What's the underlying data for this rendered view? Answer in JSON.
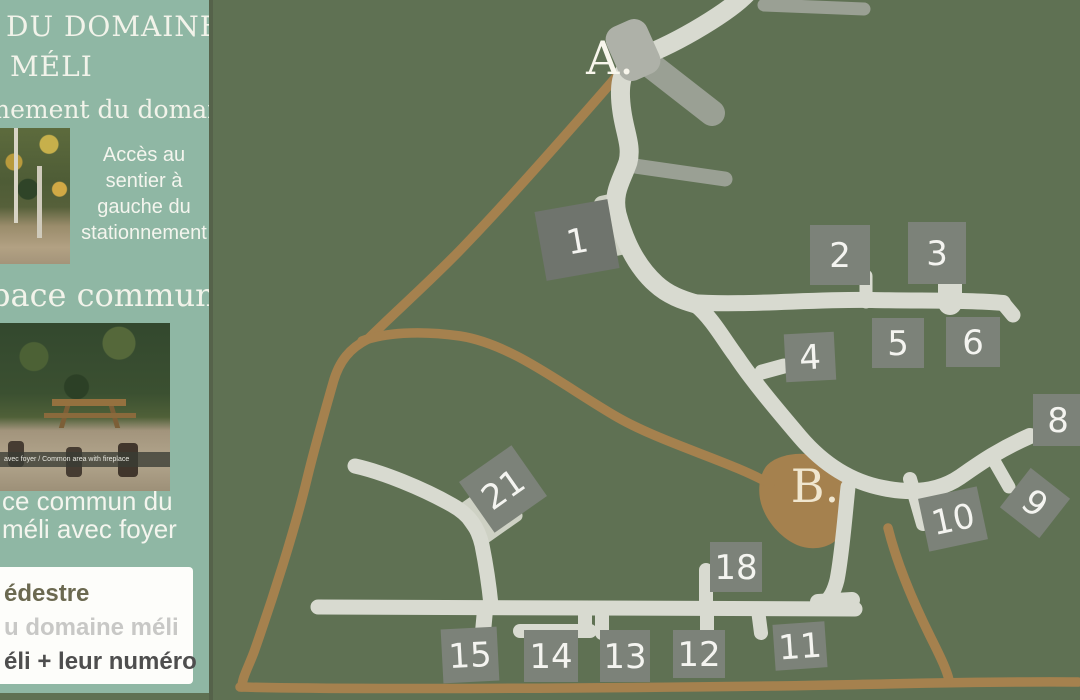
{
  "sidebar": {
    "title_line1": "DU DOMAINE",
    "title_line2": "MÉLI",
    "subtitle_fragment": "nement du domaine",
    "parking_note": "Accès au sentier à gauche du stationnement",
    "common_area_heading_fragment": "pace commun",
    "photo2_caption": "avec foyer / Common area with fireplace",
    "common_area_note_line1": "ce commun du",
    "common_area_note_line2": "méli avec foyer",
    "legend": {
      "items": [
        {
          "label": "édestre",
          "color": "#6b6950"
        },
        {
          "label": "u domaine méli",
          "color": "#c8c8c6"
        },
        {
          "label": "éli + leur numéro",
          "color": "#4e4e4e"
        }
      ]
    }
  },
  "map": {
    "label_a": "A.",
    "label_b": "B.",
    "sites": [
      {
        "label": "1"
      },
      {
        "label": "2"
      },
      {
        "label": "3"
      },
      {
        "label": "4"
      },
      {
        "label": "5"
      },
      {
        "label": "6"
      },
      {
        "label": "8"
      },
      {
        "label": "9"
      },
      {
        "label": "10"
      },
      {
        "label": "11"
      },
      {
        "label": "12"
      },
      {
        "label": "13"
      },
      {
        "label": "14"
      },
      {
        "label": "15"
      },
      {
        "label": "18"
      },
      {
        "label": "21"
      }
    ],
    "colors": {
      "map_background": "#5f7153",
      "sidebar_background": "#8fb7a4",
      "road": "#d8dad0",
      "trail_brown": "#a5814e",
      "site_marker_gray": "#7c8279",
      "parking_gray": "#aeb1a8"
    }
  }
}
